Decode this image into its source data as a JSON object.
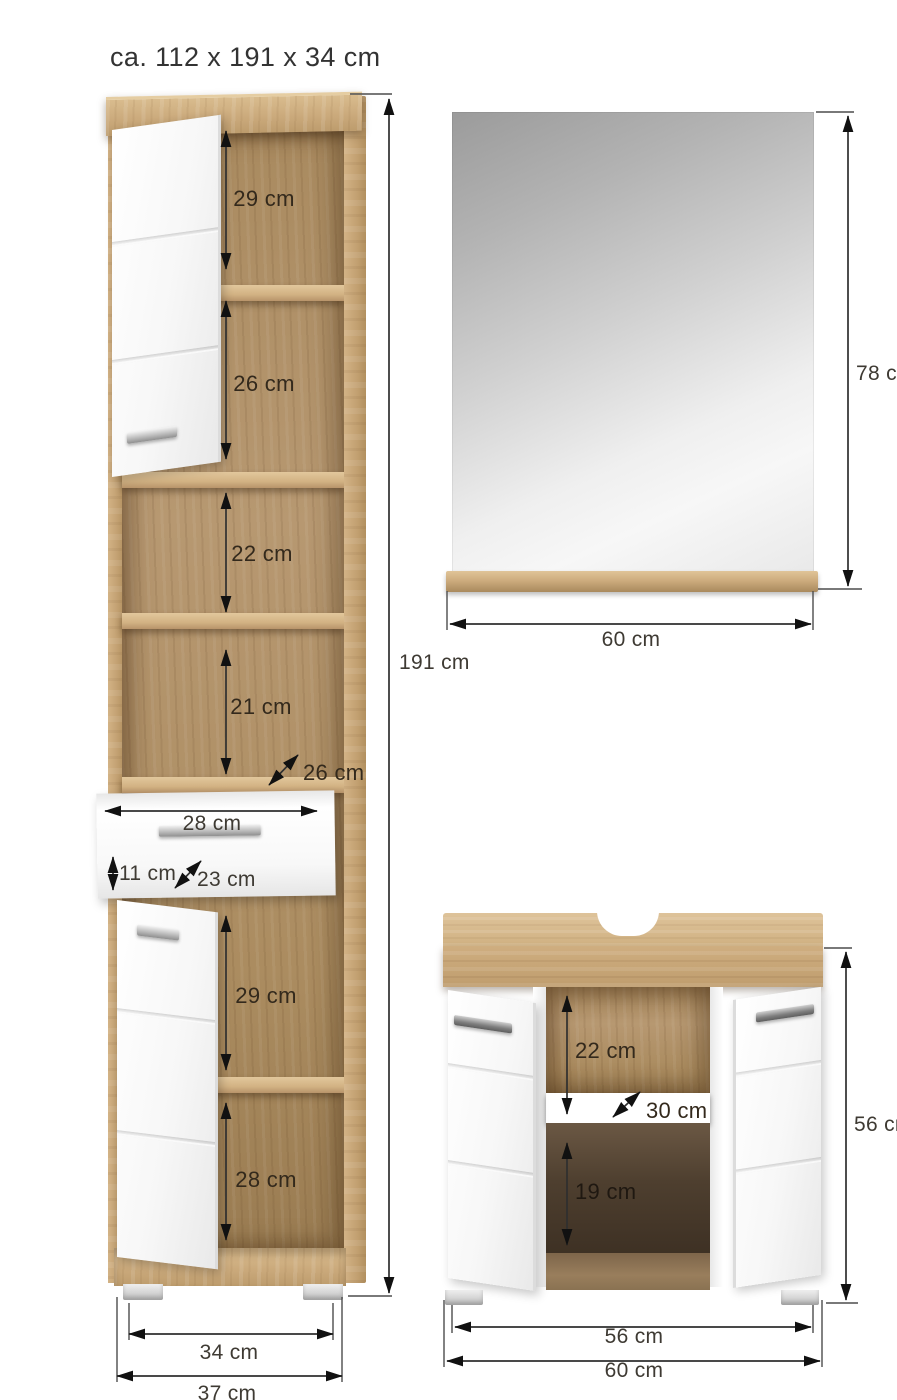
{
  "title": "ca. 112 x 191 x 34 cm",
  "tall_cabinet": {
    "compartment_1": "29 cm",
    "compartment_2": "26 cm",
    "compartment_3": "22 cm",
    "compartment_4": "21 cm",
    "shelf_depth": "26 cm",
    "drawer_width": "28 cm",
    "drawer_height": "11 cm",
    "drawer_depth": "23 cm",
    "compartment_5": "29 cm",
    "compartment_6": "28 cm",
    "total_height": "191 cm",
    "base_width": "34 cm",
    "total_width": "37 cm"
  },
  "mirror": {
    "height": "78 cm",
    "width": "60 cm"
  },
  "vanity": {
    "upper_clearance": "22 cm",
    "shelf_depth": "30 cm",
    "lower_clearance": "19 cm",
    "total_height": "56 cm",
    "inner_width": "56 cm",
    "total_width": "60 cm"
  },
  "colors": {
    "wood": "#cbaa7c",
    "wood_dark": "#9a7c52",
    "interior_shadow": "#4e3f2f",
    "panel_white": "#f6f6f6",
    "mirror_gray": "#c7c7c7",
    "dimension_line": "#2f2f2f",
    "label_text": "#3a342c"
  }
}
